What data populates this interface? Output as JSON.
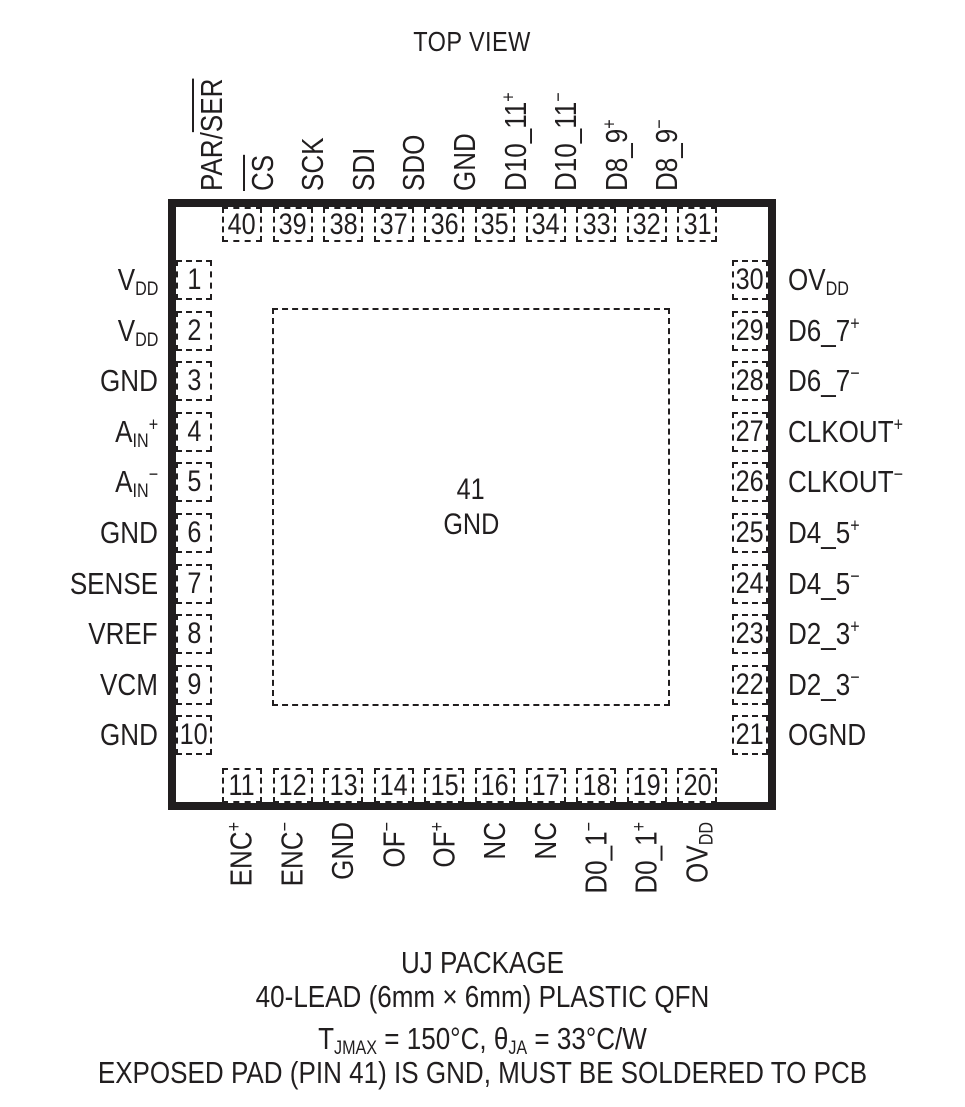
{
  "colors": {
    "ink": "#211e1f",
    "background": "#ffffff"
  },
  "title": "TOP VIEW",
  "package": {
    "top_pins": [
      {
        "num": "40",
        "label": [
          {
            "t": "PAR/"
          },
          {
            "t": "SER",
            "s": "over"
          }
        ]
      },
      {
        "num": "39",
        "label": [
          {
            "t": "CS",
            "s": "over"
          }
        ]
      },
      {
        "num": "38",
        "label": [
          {
            "t": "SCK"
          }
        ]
      },
      {
        "num": "37",
        "label": [
          {
            "t": "SDI"
          }
        ]
      },
      {
        "num": "36",
        "label": [
          {
            "t": "SDO"
          }
        ]
      },
      {
        "num": "35",
        "label": [
          {
            "t": "GND"
          }
        ]
      },
      {
        "num": "34",
        "label": [
          {
            "t": "D10_11"
          },
          {
            "t": "+",
            "s": "sup"
          }
        ]
      },
      {
        "num": "33",
        "label": [
          {
            "t": "D10_11"
          },
          {
            "t": "−",
            "s": "sup"
          }
        ]
      },
      {
        "num": "32",
        "label": [
          {
            "t": "D8_9"
          },
          {
            "t": "+",
            "s": "sup"
          }
        ]
      },
      {
        "num": "31",
        "label": [
          {
            "t": "D8_9"
          },
          {
            "t": "−",
            "s": "sup"
          }
        ]
      }
    ],
    "left_pins": [
      {
        "num": "1",
        "label": [
          {
            "t": "V"
          },
          {
            "t": "DD",
            "s": "sub"
          }
        ]
      },
      {
        "num": "2",
        "label": [
          {
            "t": "V"
          },
          {
            "t": "DD",
            "s": "sub"
          }
        ]
      },
      {
        "num": "3",
        "label": [
          {
            "t": "GND"
          }
        ]
      },
      {
        "num": "4",
        "label": [
          {
            "t": "A"
          },
          {
            "t": "IN",
            "s": "sub"
          },
          {
            "t": "+",
            "s": "sup"
          }
        ]
      },
      {
        "num": "5",
        "label": [
          {
            "t": "A"
          },
          {
            "t": "IN",
            "s": "sub"
          },
          {
            "t": "−",
            "s": "sup"
          }
        ]
      },
      {
        "num": "6",
        "label": [
          {
            "t": "GND"
          }
        ]
      },
      {
        "num": "7",
        "label": [
          {
            "t": "SENSE"
          }
        ]
      },
      {
        "num": "8",
        "label": [
          {
            "t": "VREF"
          }
        ]
      },
      {
        "num": "9",
        "label": [
          {
            "t": "VCM"
          }
        ]
      },
      {
        "num": "10",
        "label": [
          {
            "t": "GND"
          }
        ]
      }
    ],
    "right_pins": [
      {
        "num": "30",
        "label": [
          {
            "t": "OV"
          },
          {
            "t": "DD",
            "s": "sub"
          }
        ]
      },
      {
        "num": "29",
        "label": [
          {
            "t": "D6_7"
          },
          {
            "t": "+",
            "s": "sup"
          }
        ]
      },
      {
        "num": "28",
        "label": [
          {
            "t": "D6_7"
          },
          {
            "t": "−",
            "s": "sup"
          }
        ]
      },
      {
        "num": "27",
        "label": [
          {
            "t": "CLKOUT"
          },
          {
            "t": "+",
            "s": "sup"
          }
        ]
      },
      {
        "num": "26",
        "label": [
          {
            "t": "CLKOUT"
          },
          {
            "t": "−",
            "s": "sup"
          }
        ]
      },
      {
        "num": "25",
        "label": [
          {
            "t": "D4_5"
          },
          {
            "t": "+",
            "s": "sup"
          }
        ]
      },
      {
        "num": "24",
        "label": [
          {
            "t": "D4_5"
          },
          {
            "t": "−",
            "s": "sup"
          }
        ]
      },
      {
        "num": "23",
        "label": [
          {
            "t": "D2_3"
          },
          {
            "t": "+",
            "s": "sup"
          }
        ]
      },
      {
        "num": "22",
        "label": [
          {
            "t": "D2_3"
          },
          {
            "t": "−",
            "s": "sup"
          }
        ]
      },
      {
        "num": "21",
        "label": [
          {
            "t": "OGND"
          }
        ]
      }
    ],
    "bottom_pins": [
      {
        "num": "11",
        "label": [
          {
            "t": "ENC"
          },
          {
            "t": "+",
            "s": "sup"
          }
        ]
      },
      {
        "num": "12",
        "label": [
          {
            "t": "ENC"
          },
          {
            "t": "−",
            "s": "sup"
          }
        ]
      },
      {
        "num": "13",
        "label": [
          {
            "t": "GND"
          }
        ]
      },
      {
        "num": "14",
        "label": [
          {
            "t": "OF"
          },
          {
            "t": "−",
            "s": "sup"
          }
        ]
      },
      {
        "num": "15",
        "label": [
          {
            "t": "OF"
          },
          {
            "t": "+",
            "s": "sup"
          }
        ]
      },
      {
        "num": "16",
        "label": [
          {
            "t": "NC"
          }
        ]
      },
      {
        "num": "17",
        "label": [
          {
            "t": "NC"
          }
        ]
      },
      {
        "num": "18",
        "label": [
          {
            "t": "D0_1"
          },
          {
            "t": "−",
            "s": "sup"
          }
        ]
      },
      {
        "num": "19",
        "label": [
          {
            "t": "D0_1"
          },
          {
            "t": "+",
            "s": "sup"
          }
        ]
      },
      {
        "num": "20",
        "label": [
          {
            "t": "OV"
          },
          {
            "t": "DD",
            "s": "sub"
          }
        ]
      }
    ],
    "exposed_pad": {
      "num": "41",
      "label": "GND"
    }
  },
  "footer": {
    "package_name": "UJ PACKAGE",
    "package_desc": "40-LEAD (6mm × 6mm) PLASTIC QFN",
    "thermal": [
      {
        "t": "T"
      },
      {
        "t": "JMAX",
        "s": "sub"
      },
      {
        "t": " = 150°C, θ"
      },
      {
        "t": "JA",
        "s": "sub"
      },
      {
        "t": " = 33°C/W"
      }
    ],
    "note": "EXPOSED PAD (PIN 41) IS GND, MUST BE SOLDERED TO PCB"
  }
}
